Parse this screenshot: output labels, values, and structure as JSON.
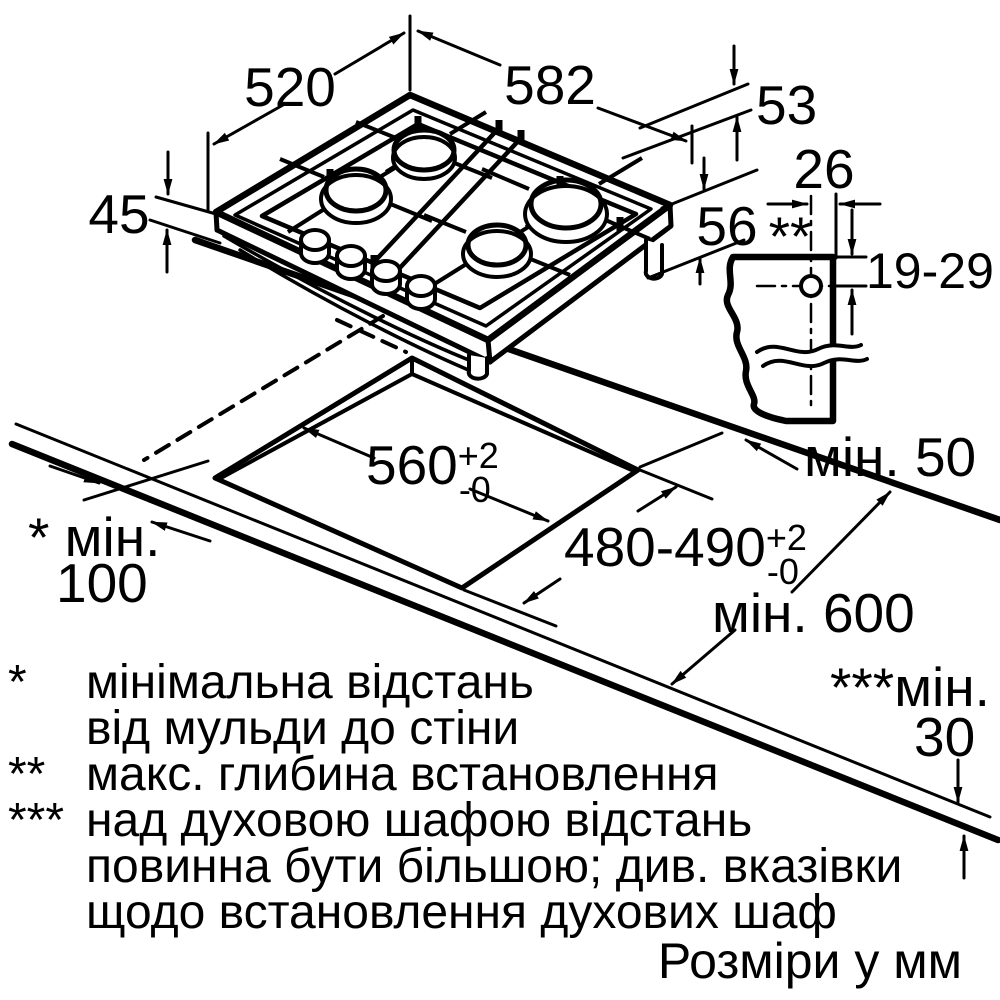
{
  "colors": {
    "ink": "#000000",
    "paper": "#ffffff",
    "burner": "#c9c9c9"
  },
  "hob": {
    "depth": "520",
    "width": "582",
    "height_rim": "53",
    "height_front": "45",
    "height_body": "56"
  },
  "section": {
    "marker": "**",
    "hole_offset": "26",
    "hole_range": "19-29"
  },
  "cutout": {
    "width": "560",
    "width_tol_plus": "+2",
    "width_tol_minus": "-0",
    "depth": "480-490",
    "depth_tol_plus": "+2",
    "depth_tol_minus": "-0"
  },
  "clearances": {
    "back": "мін. 50",
    "side_line1": "* мін.",
    "side_line2": "100",
    "worktop_depth": "мін. 600",
    "bottom_line1": "***мін.",
    "bottom_line2": "30"
  },
  "footnotes": [
    {
      "marker": "*",
      "lines": [
        "мінімальна відстань",
        "від мульди до стіни"
      ]
    },
    {
      "marker": "**",
      "lines": [
        "макс. глибина встановлення"
      ]
    },
    {
      "marker": "***",
      "lines": [
        "над духовою шафою відстань",
        "повинна бути більшою; див. вказівки",
        "щодо встановлення духових шаф"
      ]
    }
  ],
  "caption": "Розміри у мм"
}
